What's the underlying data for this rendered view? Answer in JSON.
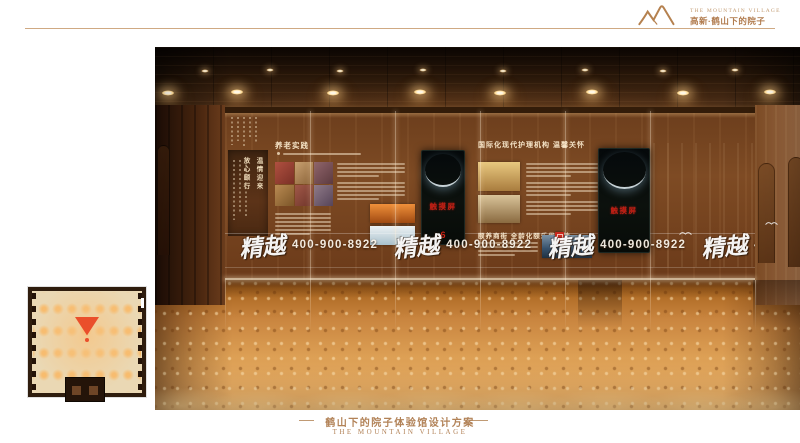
{
  "header": {
    "logo_en": "The Mountain Village",
    "logo_zh": "高新·鹤山下的院子"
  },
  "hall": {
    "banner_slogan_col1": "温情迎来",
    "banner_slogan_col2": "放心颐行",
    "section_practice_title": "养老实践",
    "section_care_title": "国际化现代护理机构 温馨关怀",
    "section_street_title": "颐养商街 全龄化颐乐优享地",
    "touchscreen_label": "触摸屏",
    "touchscreen_number": "6",
    "watermark_calligraphy": "精越",
    "watermark_phone": "400-900-8922"
  },
  "footer": {
    "title_zh": "鹤山下的院子体验馆设计方案",
    "title_en": "THE MOUNTAIN VILLAGE"
  },
  "icons": {
    "logo": "mountain-peaks",
    "glass_decor": "seagull",
    "city_photo_badge": "red-seal-stamp",
    "plan_marker": "view-direction-triangle"
  },
  "colors": {
    "accent_brown": "#b28257",
    "screen_label_red": "#c52015",
    "marker_red": "#ea4f2b",
    "floor_orange": "#d6924a",
    "ceiling_brown": "#2a180a"
  }
}
